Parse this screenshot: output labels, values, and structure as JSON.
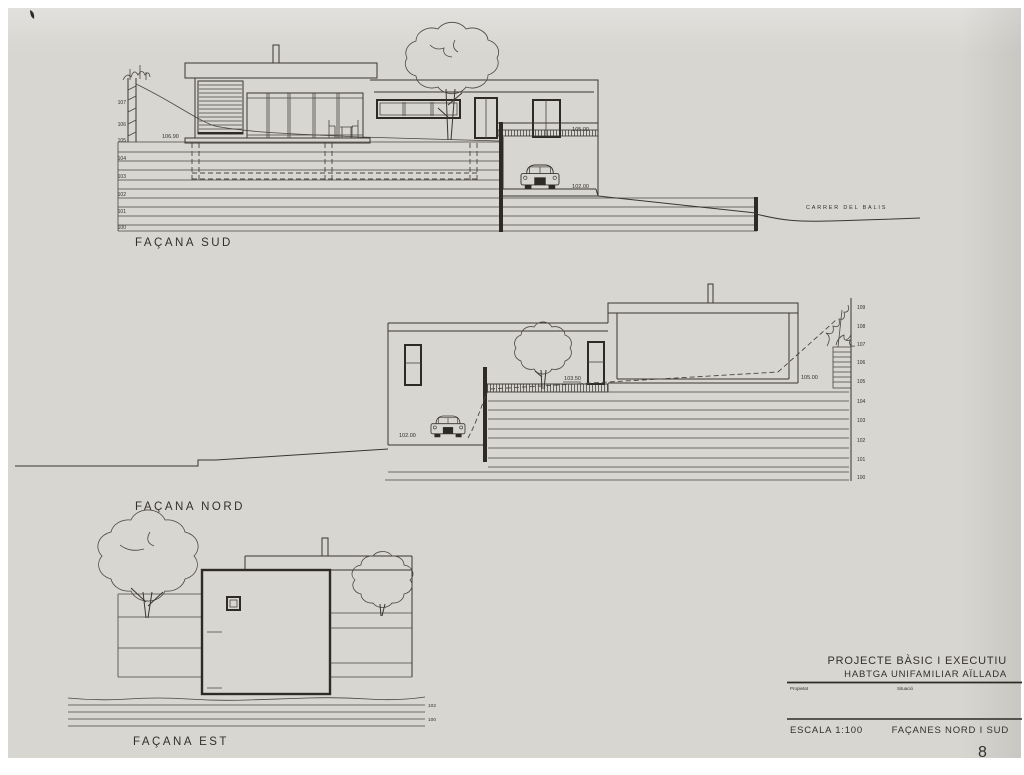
{
  "colors": {
    "paper": "#d8d6d1",
    "ink": "#33302b"
  },
  "drawings": {
    "sud": {
      "label": "FAÇANA SUD",
      "levels": [
        "107",
        "106",
        "105",
        "104",
        "103",
        "102",
        "101",
        "100"
      ],
      "spot_base": "106.90",
      "spot_balcony": "105.00",
      "spot_garage": "102.00",
      "street": "CARRER DEL BALIS"
    },
    "nord": {
      "label": "FAÇANA NORD",
      "levels": [
        "109",
        "108",
        "107",
        "106",
        "105",
        "104",
        "103",
        "102",
        "101",
        "100"
      ],
      "spot_garage": "102.00",
      "spot_terrace": "103.50",
      "spot_right": "105.00"
    },
    "est": {
      "label": "FAÇANA EST",
      "mark_upper": "102",
      "mark_lower": "100"
    }
  },
  "title_block": {
    "project_line1": "PROJECTE BÀSIC I EXECUTIU",
    "project_line2": "HABTGA UNIFAMILIAR AÏLLADA",
    "field_left": "Propietat",
    "field_right": "Situació",
    "scale": "ESCALA 1:100",
    "sheet_title": "FAÇANES NORD I SUD",
    "sheet_number": "8"
  }
}
